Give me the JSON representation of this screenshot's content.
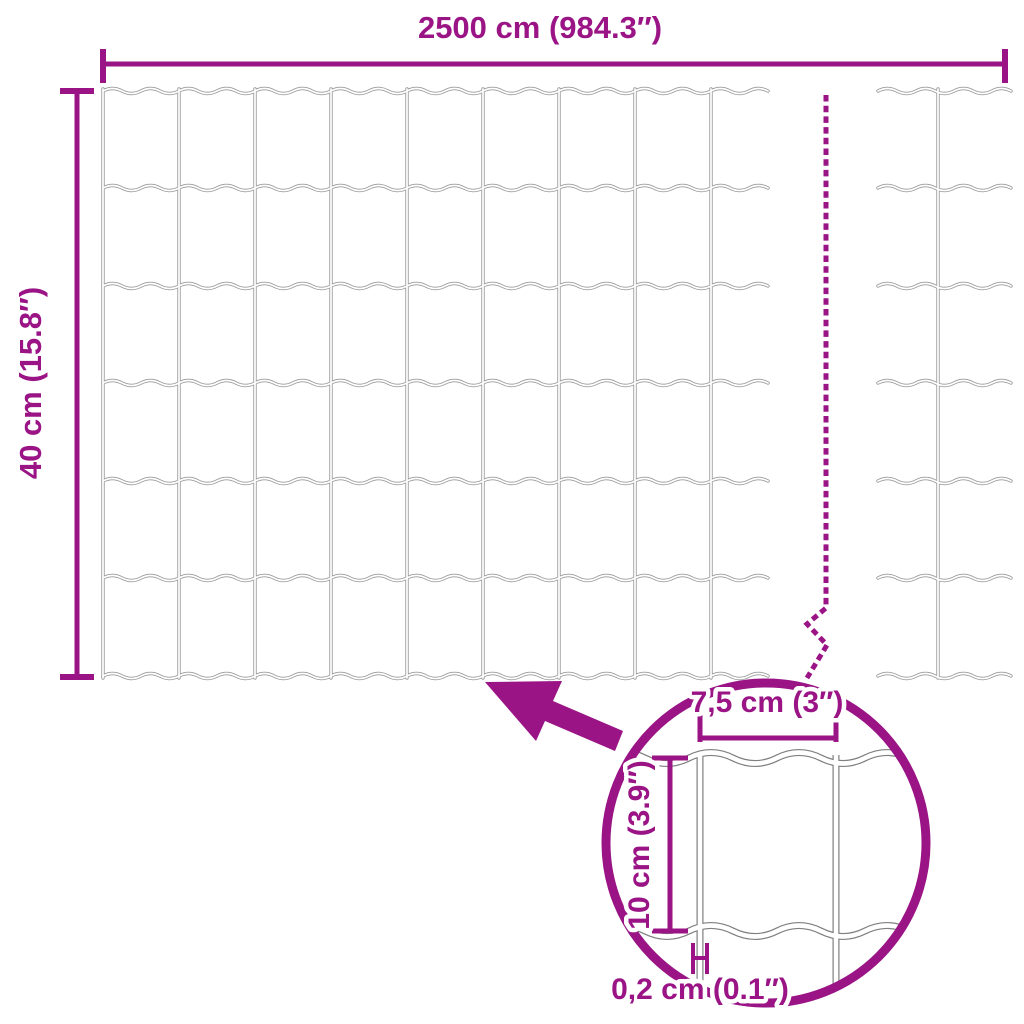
{
  "colors": {
    "accent": "#9A1486",
    "wire": "#9B9B9B",
    "detail_wire": "#7F7F7F",
    "background": "#FFFFFF"
  },
  "overall_dimensions": {
    "width_label": "2500 cm (984.3″)",
    "height_label": "40 cm (15.8″)"
  },
  "detail_dimensions": {
    "mesh_width_label": "7,5 cm (3″)",
    "mesh_height_label": "10 cm (3.9″)",
    "wire_thickness_label": "0,2 cm (0.1″)"
  }
}
